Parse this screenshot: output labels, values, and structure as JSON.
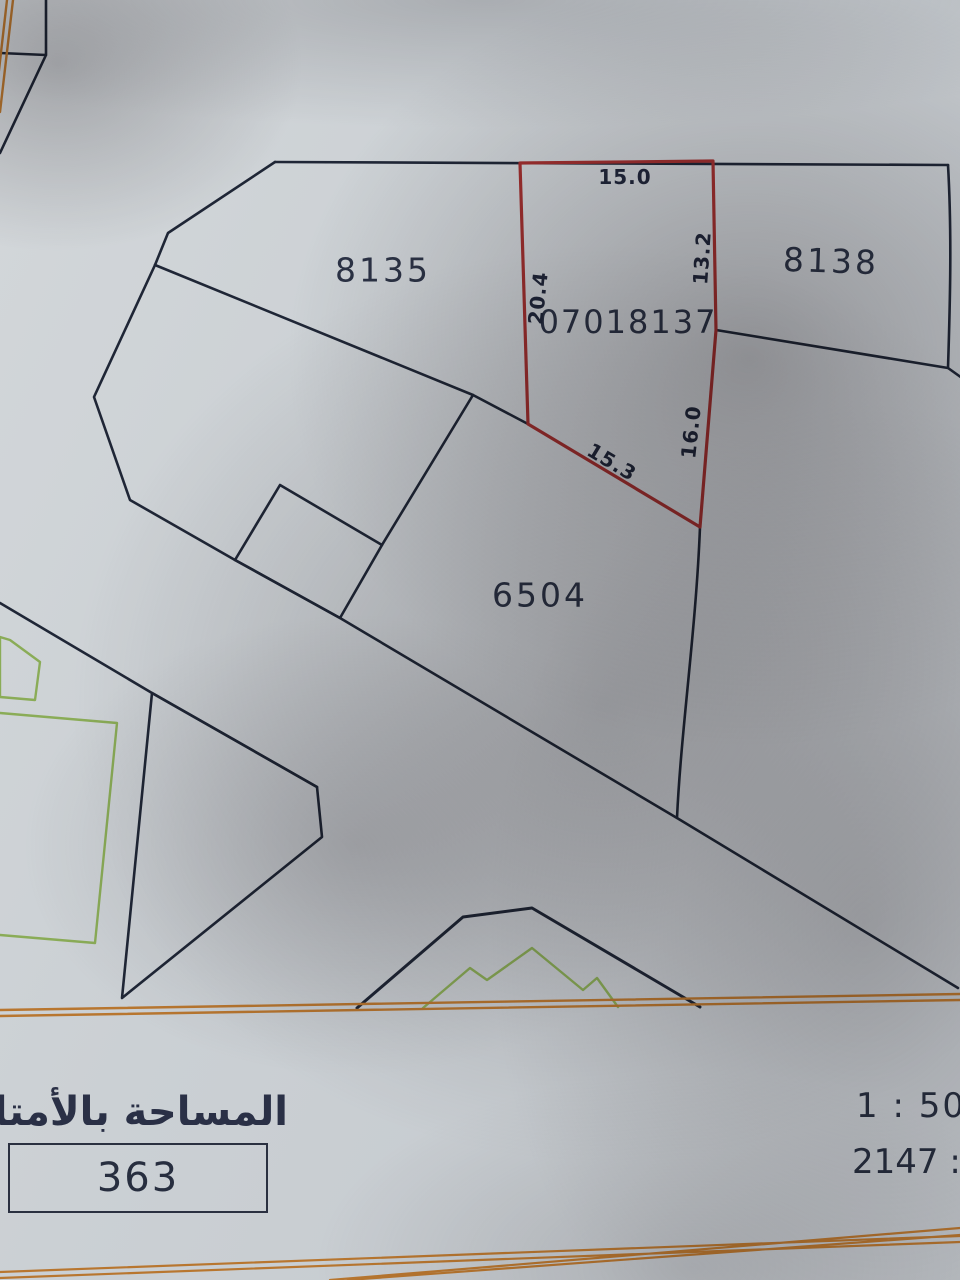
{
  "map": {
    "parcels": [
      {
        "label": "8135"
      },
      {
        "label": "8138"
      },
      {
        "label": "6504"
      }
    ],
    "red_parcel": {
      "number": "07018137"
    },
    "dimensions": [
      {
        "value": "15.0"
      },
      {
        "value": "13.2"
      },
      {
        "value": "20.4"
      },
      {
        "value": "16.0"
      },
      {
        "value": "15.3"
      }
    ],
    "colors": {
      "boundary": "#1f2636",
      "highlight_parcel": "#9e2f2f",
      "road": "#b8762f",
      "vegetation": "#8aac57",
      "paper": "#cdd2d6"
    }
  },
  "footer": {
    "area_label_ar": "المساحة بالأمتار المربعة",
    "area_value": "363",
    "scale_label": "1 : 50",
    "ref_value": "2147",
    "ref_separator": " : ",
    "ref_suffix": "يـ"
  }
}
